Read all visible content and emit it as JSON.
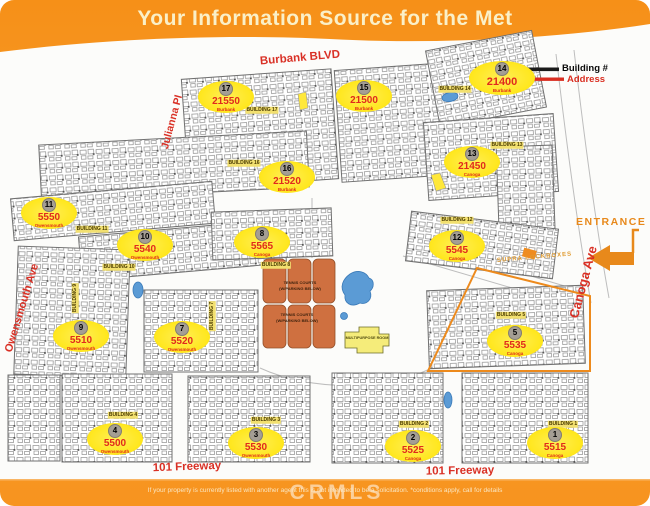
{
  "title": "Your Information Source for the Met",
  "header_legend": {
    "building_label": "Building #",
    "address_label": "Address",
    "example": {
      "number": "14",
      "address": "21400",
      "street": "Burbank"
    }
  },
  "streets": {
    "burbank": "Burbank BLVD",
    "julianna": "Julianna Pl",
    "owensmouth": "Owensmouth Ave",
    "canoga": "Canoga Ave",
    "freeway_left": "101 Freeway",
    "freeway_right": "101 Freeway"
  },
  "entrance_label": "ENTRANCE",
  "supra_label": "SUPRA LOCKBOXES",
  "buildings": [
    {
      "number": "17",
      "address": "21550",
      "street": "Burbank"
    },
    {
      "number": "15",
      "address": "21500",
      "street": "Burbank"
    },
    {
      "number": "16",
      "address": "21520",
      "street": "Burbank"
    },
    {
      "number": "13",
      "address": "21450",
      "street": "Canoga"
    },
    {
      "number": "11",
      "address": "5550",
      "street": "Owensmouth"
    },
    {
      "number": "10",
      "address": "5540",
      "street": "Owensmouth"
    },
    {
      "number": "8",
      "address": "5565",
      "street": "Canoga"
    },
    {
      "number": "12",
      "address": "5545",
      "street": "Canoga"
    },
    {
      "number": "9",
      "address": "5510",
      "street": "Owensmouth"
    },
    {
      "number": "7",
      "address": "5520",
      "street": "Owensmouth"
    },
    {
      "number": "5",
      "address": "5535",
      "street": "Canoga"
    },
    {
      "number": "4",
      "address": "5500",
      "street": "Owensmouth"
    },
    {
      "number": "3",
      "address": "5530",
      "street": "Owensmouth"
    },
    {
      "number": "2",
      "address": "5525",
      "street": "Canoga"
    },
    {
      "number": "1",
      "address": "5515",
      "street": "Canoga"
    }
  ],
  "map_building_labels": [
    "BUILDING 17",
    "BUILDING 16",
    "BUILDING 14",
    "BUILDING 13",
    "BUILDING 11",
    "BUILDING 10",
    "BUILDING 12",
    "BUILDING 8",
    "BUILDING 5",
    "BUILDING 4",
    "BUILDING 3",
    "BUILDING 2",
    "BUILDING 1",
    "BUILDING 9",
    "BUILDING 7"
  ],
  "amenities": {
    "tennis_title": "TENNIS COURTS",
    "tennis_sub": "(W/PARKING BELOW)",
    "multipurpose": "MULTIPURPOSE ROOM"
  },
  "footer": {
    "disclaimer": "If your property is currently listed with another agent this is not intended to be a solicitation. *conditions apply, call for details",
    "watermark": "CRMLS"
  },
  "colors": {
    "frame_orange": "#F7941E",
    "marker_yellow": "#FFE71F",
    "address_red": "#E02A1C",
    "street_red": "#D93025",
    "entrance_orange": "#E8891B",
    "court_terracotta": "#CF7040",
    "pool_blue": "#5B9BD5"
  }
}
